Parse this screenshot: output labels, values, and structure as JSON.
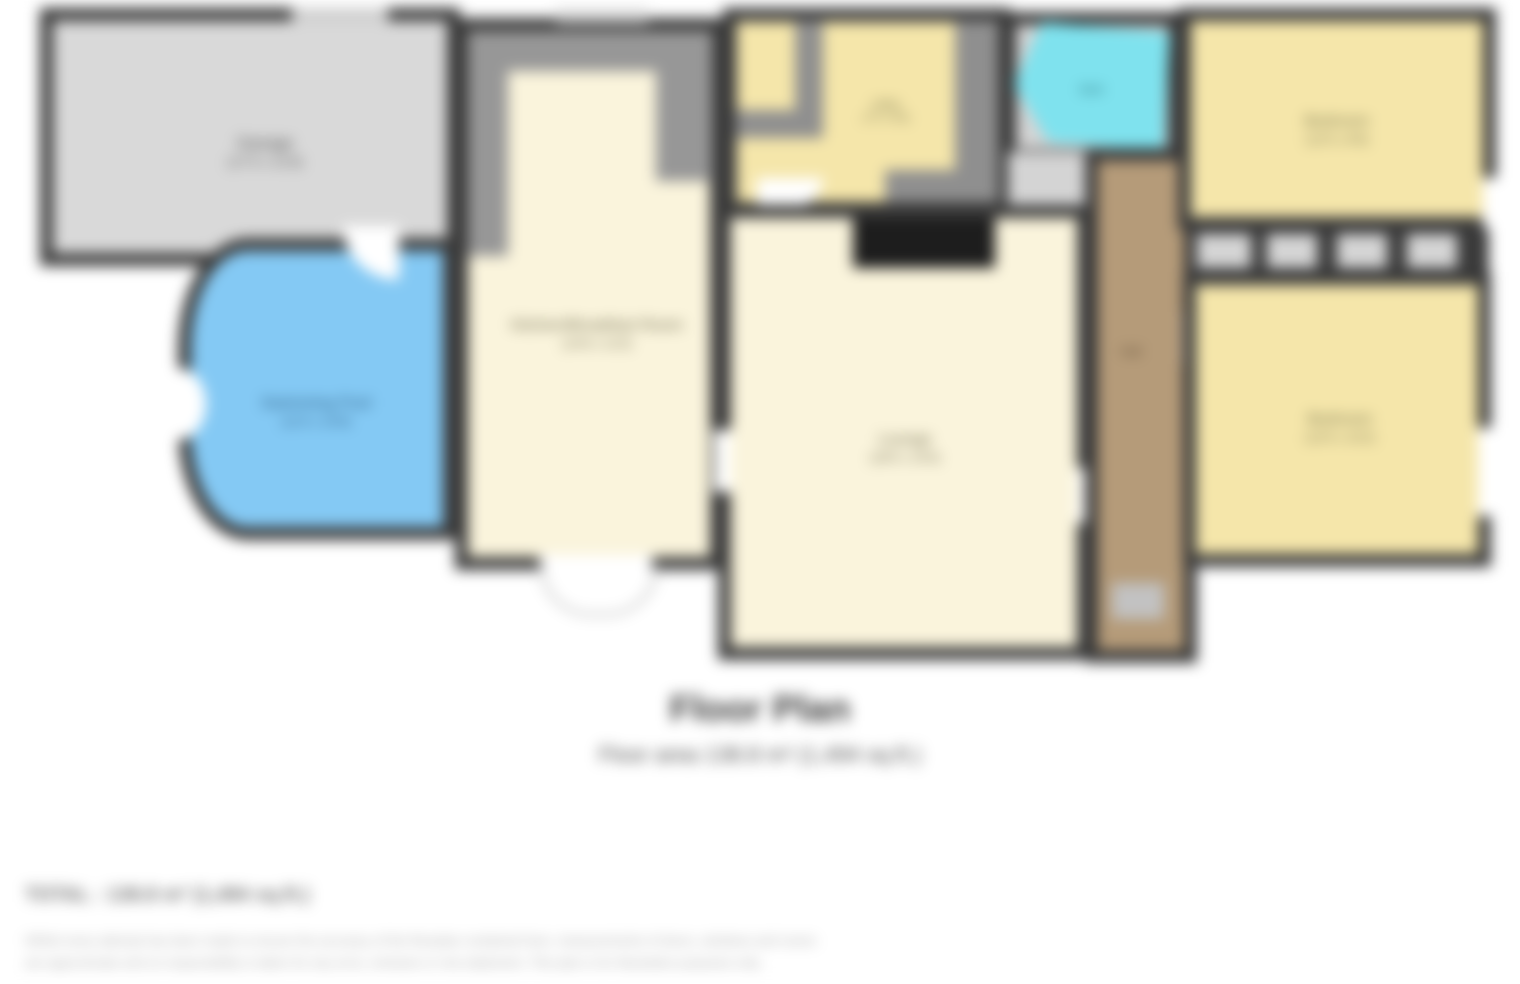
{
  "title": "Floor Plan",
  "subtitle": "Floor area 138.8 m² (1,494 sq.ft.)",
  "total": "TOTAL : 138.8 m² (1,494 sq.ft.)",
  "disclaimer": {
    "line1": "Whilst every attempt has been made to ensure the accuracy of the floorplan contained here, measurements of doors, windows and rooms",
    "line2": "are approximate and no responsibility is taken for any error, omission or mis-statement. This plan is for illustrative purposes only."
  },
  "rooms": {
    "garage": {
      "name": "Garage",
      "dims": "(17'2 x 11'9)"
    },
    "pool": {
      "name": "Swimming Pool",
      "dims": "(11'5 x 10'9)"
    },
    "kitchen": {
      "name": "Kitchen/Breakfast Room",
      "dims": "(14'6 x 11'0)"
    },
    "lounge": {
      "name": "Lounge",
      "dims": "(18'5 x 15'0)"
    },
    "utility": {
      "name": "Utility",
      "dims": "(7'5 x 6'8)"
    },
    "bath": {
      "name": "Bath"
    },
    "hall": {
      "name": "Hall"
    },
    "bedroom1": {
      "name": "Bedroom",
      "dims": "(12'5 x 8'9)"
    },
    "bedroom2": {
      "name": "Bedroom",
      "dims": "(12'5 x 10'2)"
    }
  },
  "colors": {
    "wall": "#3a3a3a",
    "garage_fill": "#d9d9d9",
    "pool_fill": "#84c9f4",
    "cream_fill": "#faf4dc",
    "yellow_fill": "#f5e6aa",
    "bath_fill": "#7fe2ee",
    "hall_fill": "#b59b79",
    "stairs_gray": "#979797",
    "wardrobe_fill": "#d5d5d5"
  }
}
